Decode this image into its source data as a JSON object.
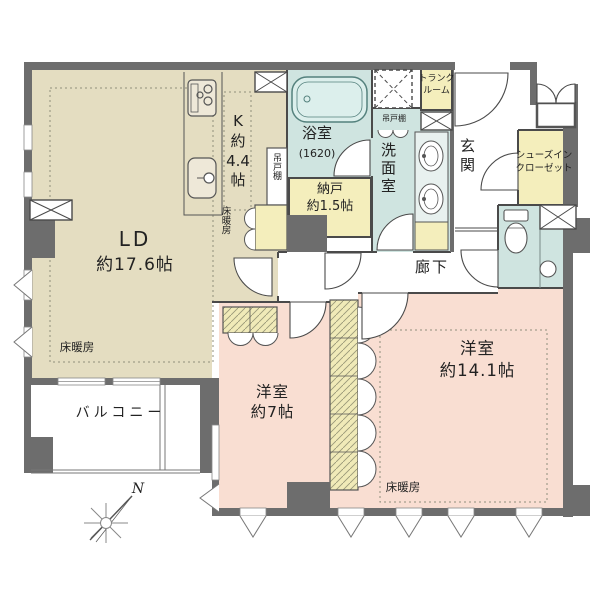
{
  "title": "マンション間取り図",
  "colors": {
    "wall": "#6d6d6d",
    "line": "#4a4a4a",
    "floor_living": "#e4ddc1",
    "floor_bedroom": "#f9ded2",
    "floor_wet": "#cfe4e0",
    "storage_yellow": "#f4eebc",
    "tub_fill": "#dcefec"
  },
  "rooms": {
    "ld": {
      "name": "LD",
      "size": "約17.6帖"
    },
    "kitchen": {
      "label": "K\n約\n4.4\n帖"
    },
    "bath": {
      "name": "浴室",
      "size": "(1620)"
    },
    "nando": {
      "label": "納戸\n約1.5帖"
    },
    "senmen": {
      "name": "洗面室"
    },
    "trunk": {
      "label": "トランク\nルーム"
    },
    "genkan": {
      "name": "玄関"
    },
    "sic": {
      "label": "シューズイン\nクローゼット"
    },
    "rouka": {
      "name": "廊下"
    },
    "west7": {
      "label": "洋室\n約7帖"
    },
    "west14": {
      "label": "洋室\n約14.1帖"
    },
    "balcony": {
      "name": "バルコニー"
    }
  },
  "annotations": {
    "floor_heating": "床暖房",
    "hanging_cabinet": "吊戸棚",
    "north": "N"
  }
}
